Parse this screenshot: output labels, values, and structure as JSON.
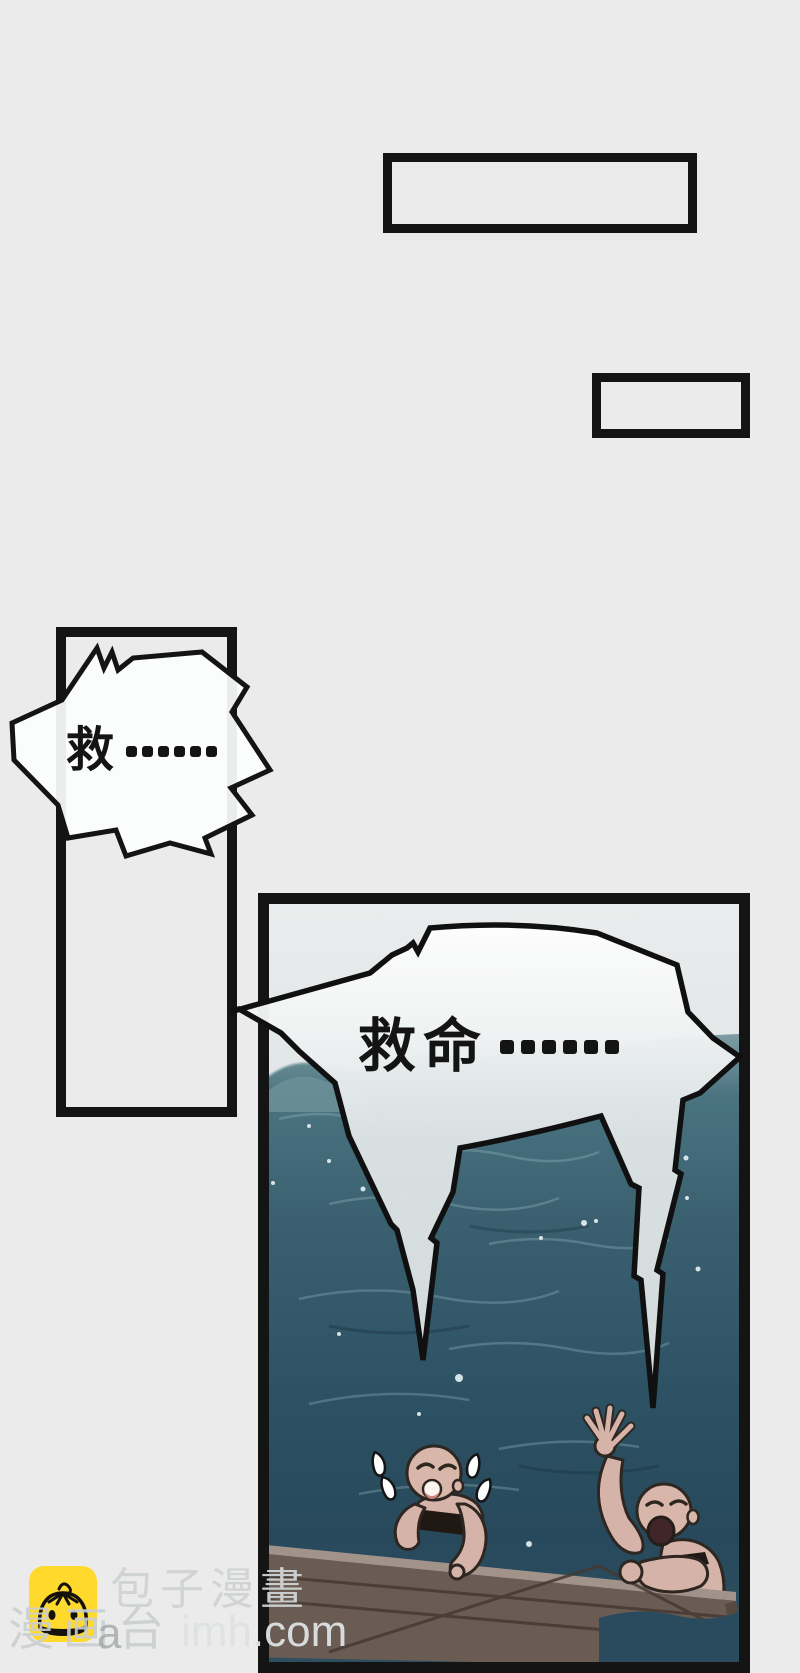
{
  "page": {
    "kind": "comic-page",
    "background": "#ecebeb"
  },
  "bubbles": {
    "left": {
      "text": "救……",
      "char": "救",
      "dots": 6
    },
    "main": {
      "text": "救命……",
      "chars": "救命",
      "dots": 6
    }
  },
  "watermark": {
    "brand": "包子漫畫",
    "platform": "漫画台",
    "overlap_letter": "a",
    "domain_fragment": "imh.com",
    "icon": "bun-app-icon",
    "icon_bg": "#ffd92c"
  },
  "colors": {
    "panel_border": "#141414",
    "sky": "#e7eaeb",
    "horizon": "#7e9da3",
    "water_mid": "#35596a",
    "water_deep": "#284a5c",
    "wood": "#6b5c53",
    "skin": "#d6b3a8",
    "bubble_fill": "#fbfcfc"
  }
}
